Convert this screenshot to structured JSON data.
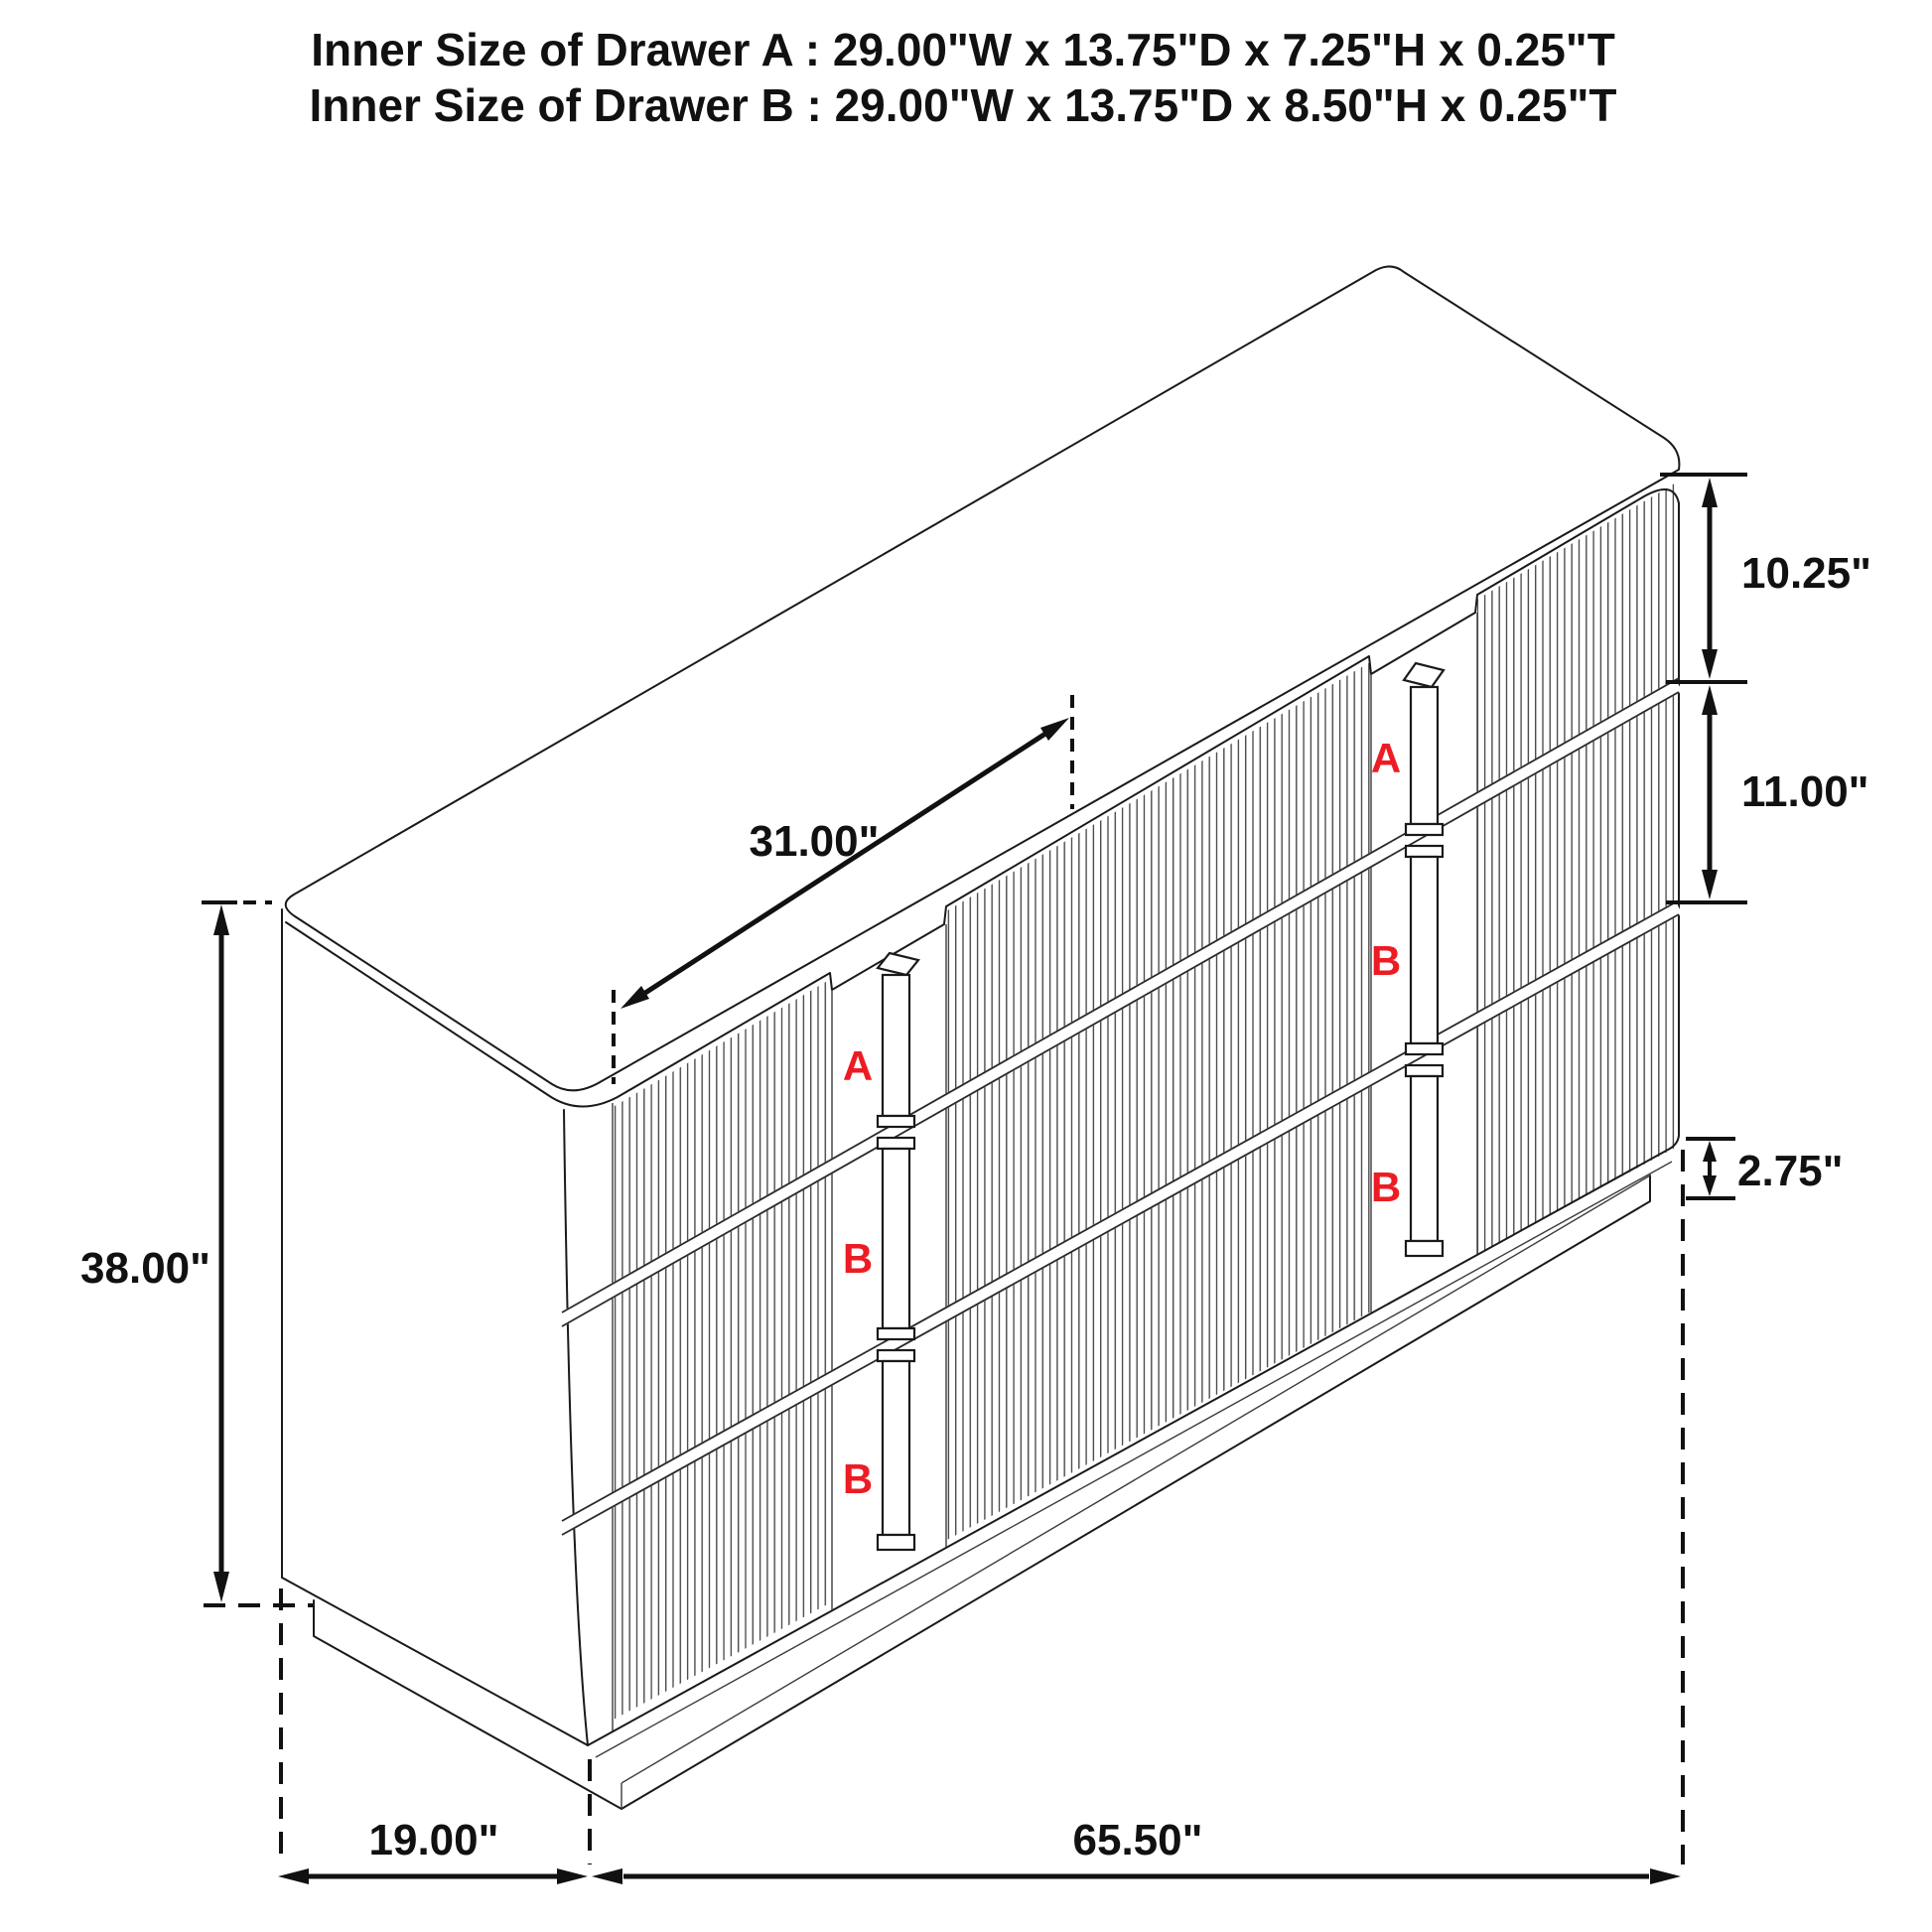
{
  "title": {
    "line1": "Inner Size of Drawer A : 29.00\"W x 13.75\"D x 7.25\"H x 0.25\"T",
    "line2": "Inner Size of Drawer B : 29.00\"W x 13.75\"D x 8.50\"H x 0.25\"T"
  },
  "dimensions": {
    "drawer_a_front_height": "10.25\"",
    "drawer_b_front_height": "11.00\"",
    "base_height": "2.75\"",
    "top_clearance_width": "31.00\"",
    "overall_height": "38.00\"",
    "overall_depth": "19.00\"",
    "overall_width": "65.50\""
  },
  "drawer_labels": {
    "left_column": [
      "A",
      "B",
      "B"
    ],
    "right_column": [
      "A",
      "B",
      "B"
    ]
  },
  "colors": {
    "line": "#1a1a1a",
    "drawer_label": "#ed1c24",
    "background": "#ffffff"
  }
}
